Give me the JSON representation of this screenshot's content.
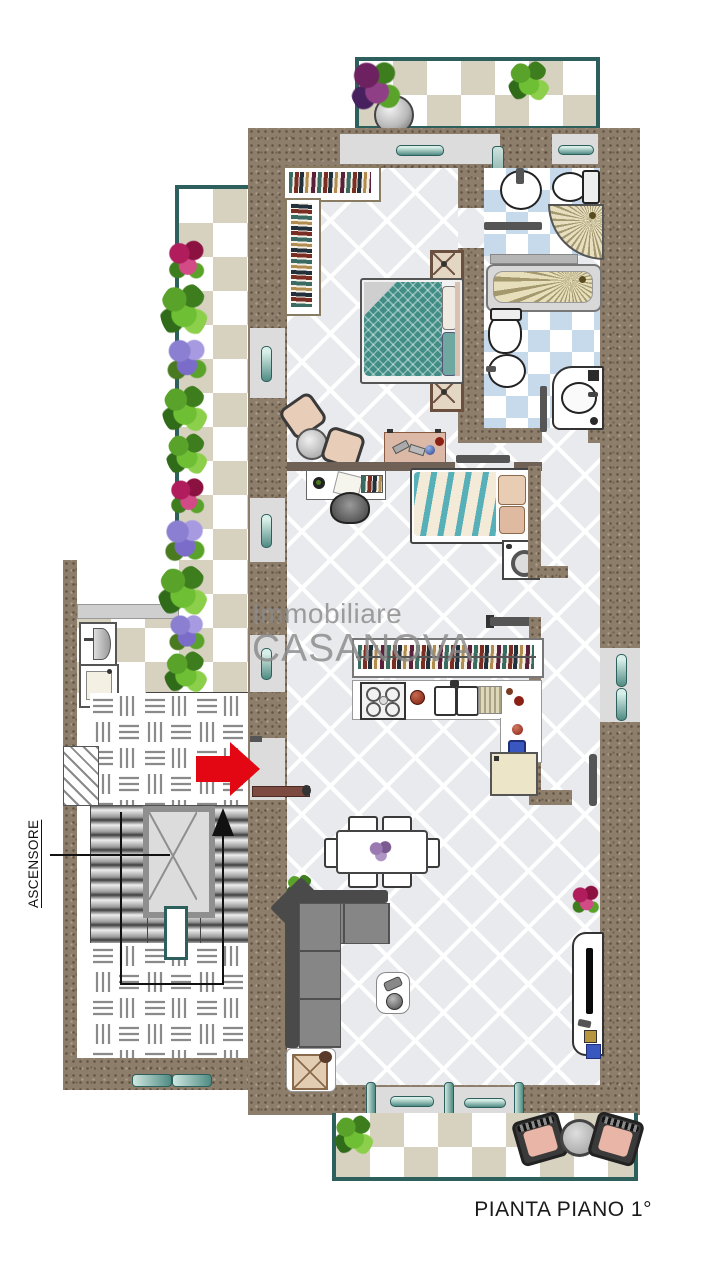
{
  "plan": {
    "caption": "PIANTA PIANO 1°"
  },
  "watermark": {
    "line1": "Immobiliare",
    "line2": "CASANOVA"
  },
  "labels": {
    "elevator": "ASCENSORE"
  },
  "colors": {
    "wall_brown": "#8d7d6b",
    "accent_teal": "#2d5f5c",
    "entrance_arrow_red": "#e30613",
    "terrace_tile_beige": "#d7d1c0",
    "bathroom_tile_blue": "#c6daec",
    "interior_floor": "#e9eaee",
    "watermark_gray": "#8a8a8a",
    "bed_teal": "#3f8d85",
    "sofa_gray": "#868686"
  }
}
